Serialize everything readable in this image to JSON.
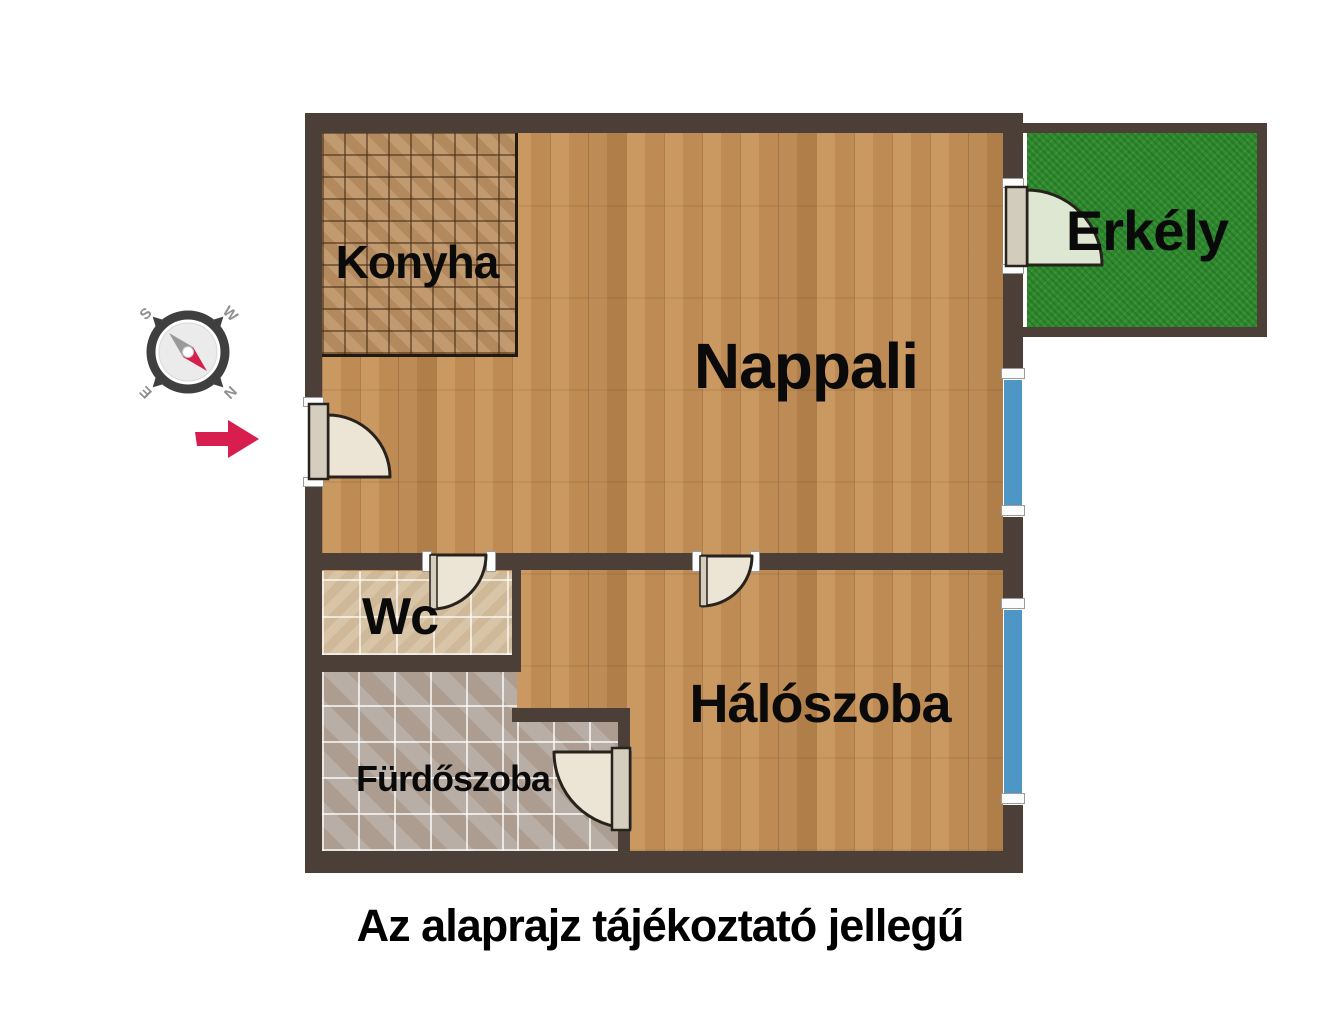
{
  "caption": "Az alaprajz tájékoztató jellegű",
  "rooms": {
    "konyha": {
      "label": "Konyha"
    },
    "nappali": {
      "label": "Nappali"
    },
    "erkely": {
      "label": "Erkély"
    },
    "wc": {
      "label": "Wc"
    },
    "haloszoba": {
      "label": "Hálószoba"
    },
    "furdoszoba": {
      "label": "Fürdőszoba"
    }
  },
  "compass": {
    "s": "S",
    "w": "W",
    "e": "E",
    "n": "N"
  },
  "colors": {
    "wall": "#4b3f37",
    "wood_floor": "#c79257",
    "kitchen_tile": "#bd9264",
    "wc_tile": "#d8c5a7",
    "bath_tile": "#b2a69c",
    "grass": "#2e8b2d",
    "window": "#4d96c5",
    "door_fill": "#ece4d4",
    "door_leaf": "#d5cebe",
    "balcony_door_fill": "#dde7d2",
    "accent_red": "#d81e4e",
    "compass_ring": "#3f3f3f",
    "label_text": "#0a0a0a"
  }
}
